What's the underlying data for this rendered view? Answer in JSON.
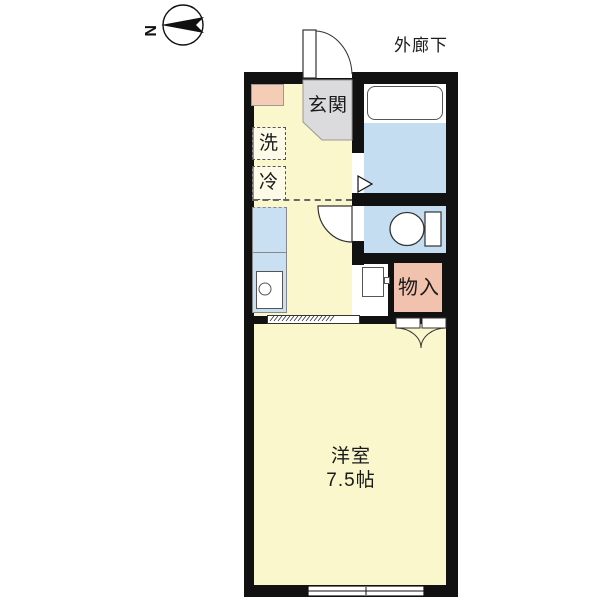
{
  "title": "apartment-floor-plan",
  "compass": {
    "letter": "N"
  },
  "labels": {
    "corridor": "外廊下",
    "entrance": "玄関",
    "washer": "洗",
    "fridge": "冷",
    "storage": "物入",
    "room_name": "洋室",
    "room_size": "7.5帖"
  },
  "rooms": [
    {
      "label": "玄関",
      "type": "entrance-hall"
    },
    {
      "label": "洋室 7.5帖",
      "type": "western-room"
    },
    {
      "label": "物入",
      "type": "storage-closet"
    }
  ],
  "fixtures": [
    "bathtub",
    "toilet",
    "kitchen-sink",
    "washing-machine-space",
    "refrigerator-space",
    "water-heater",
    "entrance-door",
    "toilet-door",
    "bathroom-folding-door",
    "sliding-door",
    "storage-double-doors",
    "window"
  ],
  "icons": {
    "compass": "north-arrow-icon"
  },
  "colors": {
    "floor_yellow": "#FBF7CC",
    "wet_area_blue": "#C5DDF0",
    "entrance_gray": "#DBDBDE",
    "accent_pink": "#F5CCB5",
    "storage_pink": "#F1C2AE",
    "wall_black": "#111111",
    "background": "#FFFFFF"
  }
}
